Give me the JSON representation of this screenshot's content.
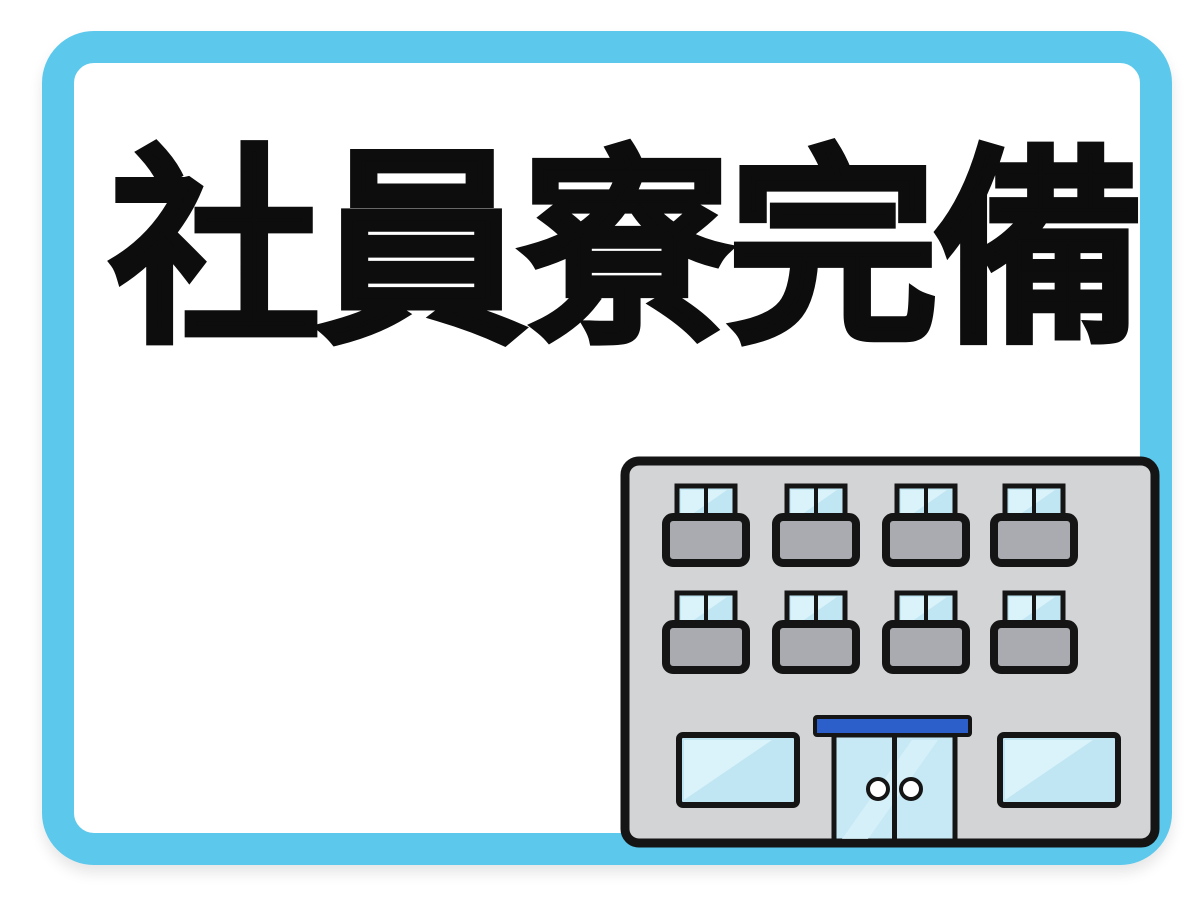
{
  "banner": {
    "title": "社員寮完備"
  },
  "illustration": {
    "name": "dormitory-building",
    "balcony_window_rows": 2,
    "balcony_windows_per_row": 4,
    "ground_floor_windows": 2,
    "entrance_door_panels": 2,
    "door_handles": 2
  },
  "colors": {
    "background": "#ffffff",
    "frame": "#5bc8ec",
    "text": "#0d0d0d",
    "outline": "#151515",
    "building_body": "#d2d4d6",
    "balcony": "#a9abb0",
    "window_glass": "#bfe6f2",
    "glass_highlight": "#daf2f9",
    "door_glass": "#c6e9f5",
    "entrance_sign": "#2c5fc9"
  }
}
